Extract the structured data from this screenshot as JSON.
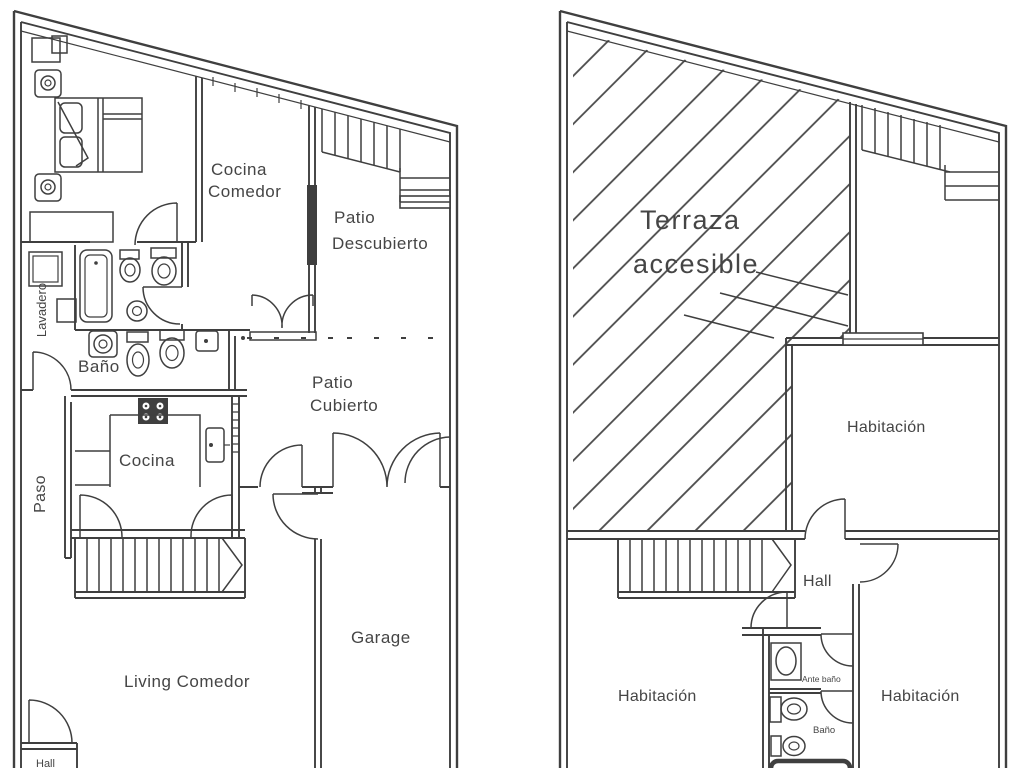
{
  "document": {
    "type": "floor-plan-drawing",
    "background": "#ffffff",
    "line_color": "#3f3f3f",
    "text_color": "#454545",
    "hatch_color": "#4a4a4a"
  },
  "ground_floor": {
    "cocina_comedor_line1": "Cocina",
    "cocina_comedor_line2": "Comedor",
    "patio_descubierto_line1": "Patio",
    "patio_descubierto_line2": "Descubierto",
    "lavadero": "Lavadero",
    "banio": "Baño",
    "patio_cubierto_line1": "Patio",
    "patio_cubierto_line2": "Cubierto",
    "cocina": "Cocina",
    "paso": "Paso",
    "garage": "Garage",
    "living_comedor": "Living Comedor",
    "hall": "Hall"
  },
  "upper_floor": {
    "terraza_line1": "Terraza",
    "terraza_line2": "accesible",
    "habitacion_top": "Habitación",
    "hall": "Hall",
    "habitacion_left": "Habitación",
    "habitacion_right": "Habitación",
    "ante_banio": "Ante baño",
    "banio": "Baño"
  }
}
